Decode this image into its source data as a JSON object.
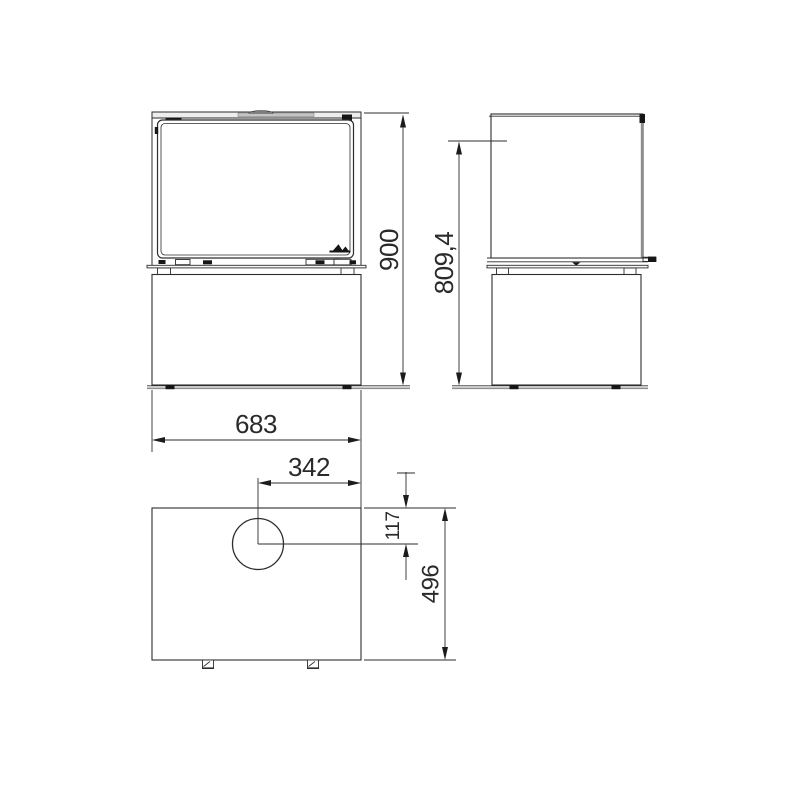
{
  "document": {
    "type": "technical-dimension-drawing",
    "subject": "freestanding stove with pedestal base shown in front, side and top orthographic views",
    "background_color": "#ffffff",
    "line_color": "#2d2d2d",
    "secondary_line_color": "#8f8f8f",
    "panel_fill_color": "#ededed"
  },
  "drawing": {
    "dimensions": {
      "height": {
        "value": "900",
        "orientation": "vertical"
      },
      "flue_height": {
        "value": "809,4",
        "orientation": "vertical"
      },
      "width": {
        "value": "683",
        "orientation": "horizontal"
      },
      "flue_offset_side": {
        "value": "342",
        "orientation": "horizontal"
      },
      "flue_offset_rear": {
        "value": "117",
        "orientation": "vertical"
      },
      "depth": {
        "value": "496",
        "orientation": "vertical"
      }
    }
  }
}
